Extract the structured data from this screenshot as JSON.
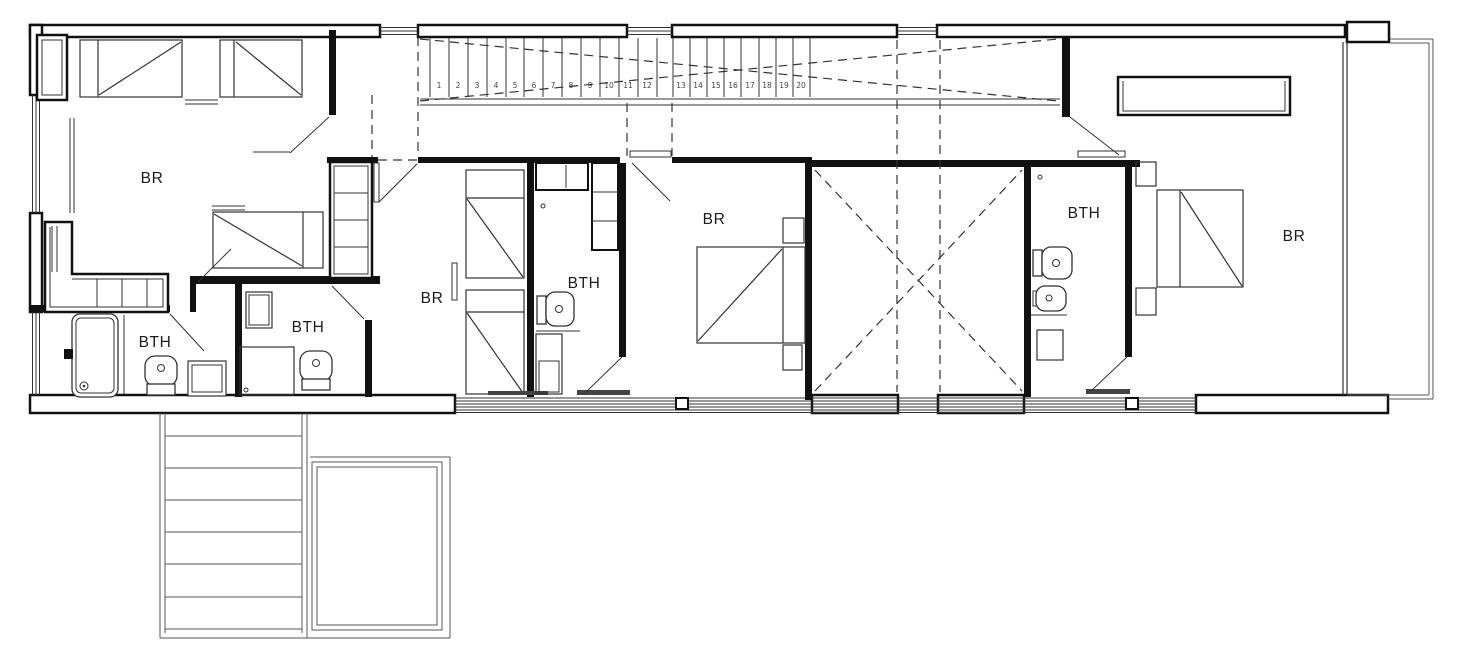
{
  "plan": {
    "colors": {
      "line": "#111111",
      "thin_line": "#333333",
      "background": "#ffffff"
    },
    "rooms": {
      "bedroom_1": {
        "label": "BR"
      },
      "bathroom_1": {
        "label": "BTH"
      },
      "bathroom_2": {
        "label": "BTH"
      },
      "bedroom_2": {
        "label": "BR"
      },
      "bathroom_3": {
        "label": "BTH"
      },
      "bedroom_3": {
        "label": "BR"
      },
      "bathroom_4": {
        "label": "BTH"
      },
      "bedroom_4": {
        "label": "BR"
      }
    },
    "stairs": {
      "steps": [
        "1",
        "2",
        "3",
        "4",
        "5",
        "6",
        "7",
        "8",
        "9",
        "10",
        "11",
        "12",
        "13",
        "14",
        "15",
        "16",
        "17",
        "18",
        "19",
        "20"
      ]
    }
  }
}
